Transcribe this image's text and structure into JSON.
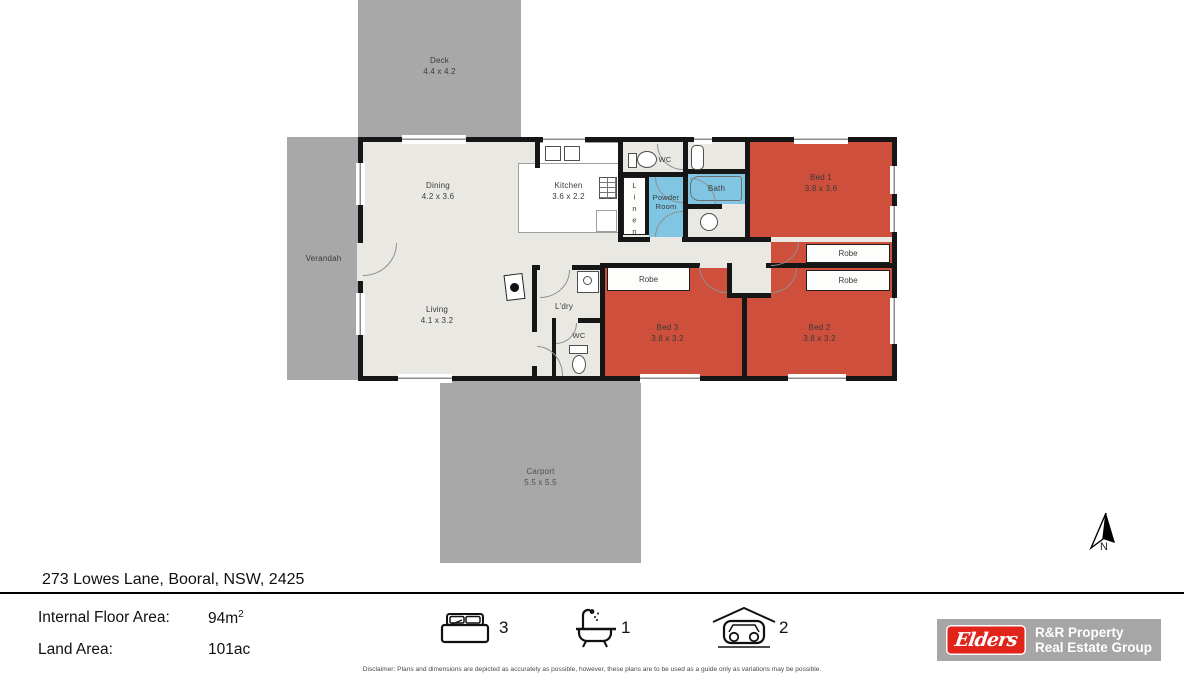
{
  "plan": {
    "deck": {
      "name": "Deck",
      "dims": "4.4 x 4.2"
    },
    "verandah": {
      "name": "Verandah"
    },
    "carport": {
      "name": "Carport",
      "dims": "5.5 x 5.5"
    },
    "dining": {
      "name": "Dining",
      "dims": "4.2 x 3.6"
    },
    "kitchen": {
      "name": "Kitchen",
      "dims": "3.6 x 2.2"
    },
    "living": {
      "name": "Living",
      "dims": "4.1 x 3.2"
    },
    "laundry": {
      "name": "L'dry"
    },
    "wc_top": {
      "name": "WC"
    },
    "wc_bottom": {
      "name": "WC"
    },
    "powder_room": {
      "name": "Powder Room"
    },
    "linen": {
      "name": "Linen"
    },
    "bath": {
      "name": "Bath"
    },
    "bed1": {
      "name": "Bed 1",
      "dims": "3.8 x 3.6"
    },
    "bed2": {
      "name": "Bed 2",
      "dims": "3.8 x 3.2"
    },
    "bed3": {
      "name": "Bed 3",
      "dims": "3.8 x 3.2"
    },
    "robe_bed1": {
      "name": "Robe"
    },
    "robe_bed2": {
      "name": "Robe"
    },
    "robe_bed3": {
      "name": "Robe"
    }
  },
  "compass": {
    "label": "N"
  },
  "footer": {
    "address": "273 Lowes Lane, Booral, NSW, 2425",
    "internal_floor_area": {
      "label": "Internal Floor Area:",
      "value": "94m",
      "sup": "2"
    },
    "land_area": {
      "label": "Land Area:",
      "value": "101ac"
    },
    "features": {
      "beds": "3",
      "baths": "1",
      "cars": "2"
    }
  },
  "branding": {
    "logo_text": "Elders",
    "agency_line1": "R&R Property",
    "agency_line2": "Real Estate Group"
  },
  "disclaimer": "Disclaimer: Plans and dimensions are depicted as accurately as possible, however, these plans are to be used as a guide only as variations may be possible.",
  "colors": {
    "outdoor_gray": "#a8a8a8",
    "floor": "#e9e8e3",
    "bedroom_red": "#ce4f3b",
    "wet_blue": "#80c6e3",
    "wall_black": "#161616",
    "elders_red": "#e2231a",
    "logo_gray": "#a6a6a6"
  }
}
